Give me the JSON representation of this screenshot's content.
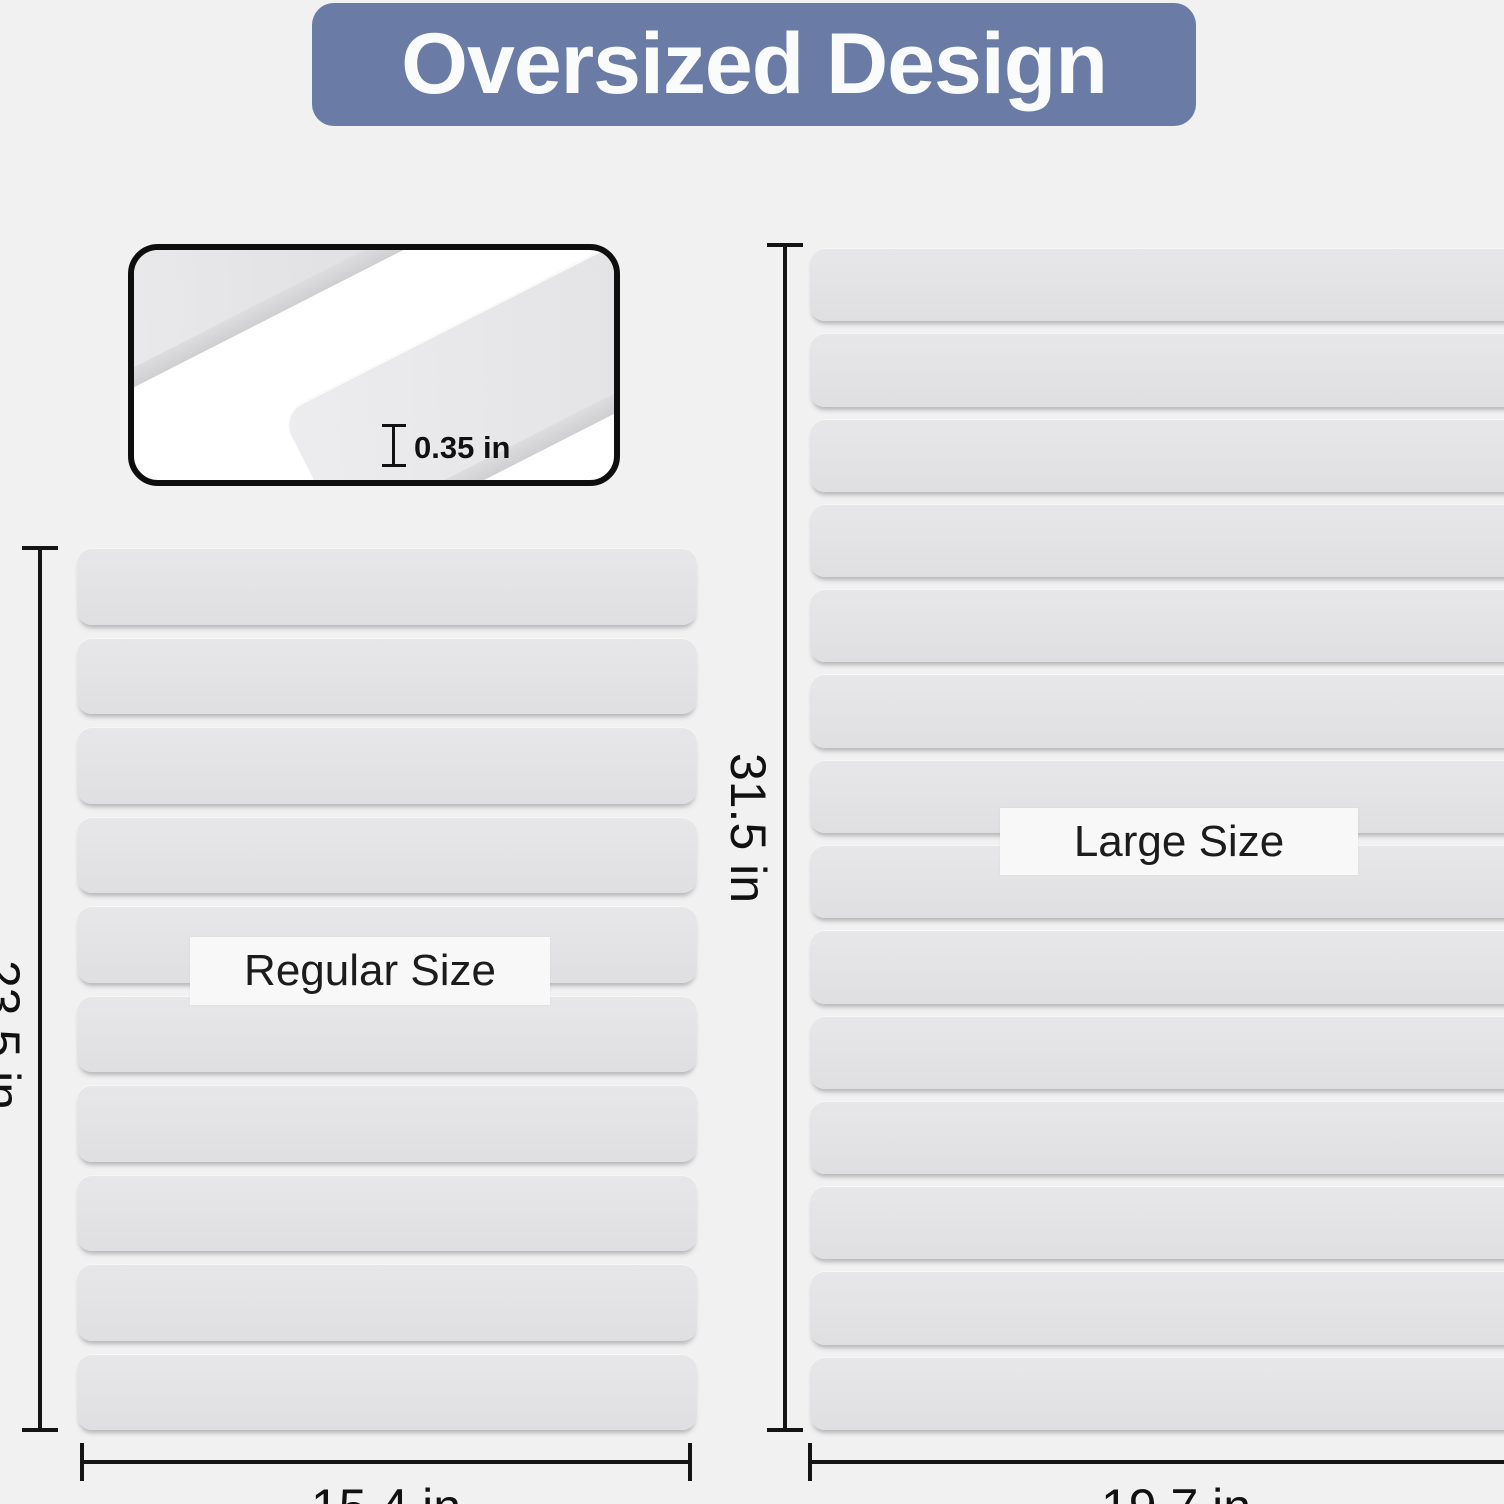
{
  "title": {
    "text": "Oversized Design",
    "banner_color": "#6a7ca6",
    "text_color": "#fafbfd"
  },
  "inset": {
    "thickness_label": "0.35 in"
  },
  "regular_mat": {
    "label": "Regular Size",
    "height_label": "23.5 in",
    "width_label": "15.4 in",
    "slat_count": 10
  },
  "large_mat": {
    "label": "Large Size",
    "height_label": "31.5 in",
    "width_label": "19.7 in",
    "slat_count": 14
  },
  "colors": {
    "page_background": "#f1f1f2",
    "slat_fill": "#e3e3e5",
    "dimension_line": "#141414",
    "tag_background": "#f8f8f8"
  }
}
